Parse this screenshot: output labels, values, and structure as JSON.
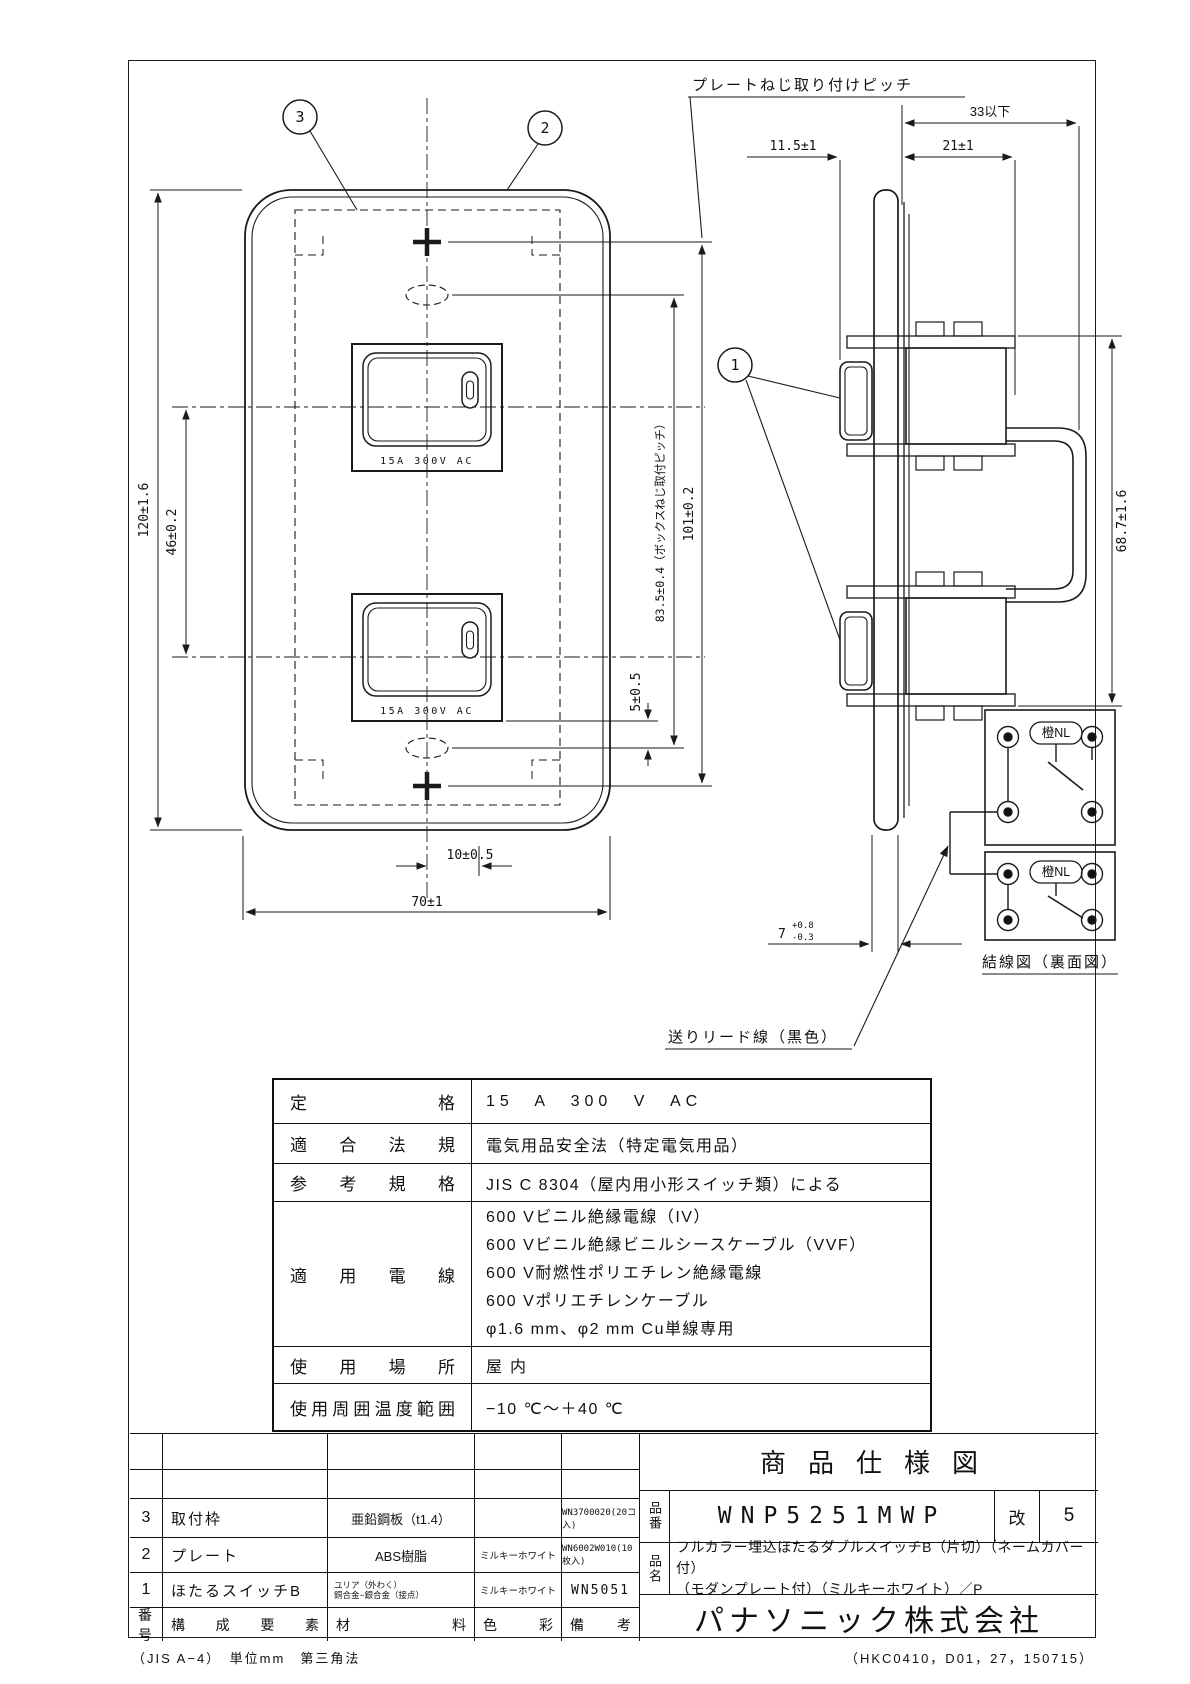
{
  "drawing": {
    "balloons": {
      "b1": "1",
      "b2": "2",
      "b3": "3"
    },
    "labels": {
      "plate_screw_pitch": "プレートねじ取り付けピッチ",
      "lead_wire": "送りリード線（黒色）",
      "wiring_title": "結線図（裏面図）",
      "lamp": "橙NL",
      "rating": "15A 300V AC"
    },
    "dims": {
      "d33": "33以下",
      "d11_5": "11.5±1",
      "d21": "21±1",
      "d120": "120±1.6",
      "d46": "46±0.2",
      "d101": "101±0.2",
      "d83_5": "83.5±0.4（ボックスねじ取付ピッチ）",
      "d5": "5±0.5",
      "d10": "10±0.5",
      "d70": "70±1",
      "d68_7": "68.7±1.6",
      "d7": "7",
      "d7p": "+0.8",
      "d7m": "-0.3"
    }
  },
  "spec_table": {
    "rows": [
      {
        "label": "定格",
        "value": "15 A 300 V AC"
      },
      {
        "label": "適合法規",
        "value": "電気用品安全法（特定電気用品）"
      },
      {
        "label": "参考規格",
        "value": "JIS C 8304（屋内用小形スイッチ類）による"
      },
      {
        "label": "適用電線",
        "lines": [
          "600 Vビニル絶縁電線（IV）",
          "600 Vビニル絶縁ビニルシースケーブル（VVF）",
          "600 V耐燃性ポリエチレン絶縁電線",
          "600 Vポリエチレンケーブル",
          "φ1.6 mm、φ2 mm Cu単線専用"
        ]
      },
      {
        "label": "使用場所",
        "value": "屋内"
      },
      {
        "label": "使用周囲温度範囲",
        "value": "−10 ℃～＋40 ℃"
      }
    ]
  },
  "parts_table": {
    "headers": [
      "番号",
      "構成要素",
      "材料",
      "色彩",
      "備考"
    ],
    "rows": [
      {
        "no": "3",
        "component": "取付枠",
        "material": "亜鉛鋼板（t1.4）",
        "material2": "",
        "color": "",
        "note": "WN3700020(20コ入)"
      },
      {
        "no": "2",
        "component": "プレート",
        "material": "ABS樹脂",
        "material2": "",
        "color": "ミルキーホワイト",
        "note": "WN6002W010(10枚入)"
      },
      {
        "no": "1",
        "component": "ほたるスイッチB",
        "material": "ユリア（外わく）",
        "material2": "銅合金−銀合金（接点）",
        "color": "ミルキーホワイト",
        "note": "WN5051"
      }
    ]
  },
  "title_block": {
    "title": "商品仕様図",
    "part_no_label": "品番",
    "part_no": "WNP5251MWP",
    "rev_label": "改",
    "rev": "5",
    "name_label": "品名",
    "name_line1": "フルカラー埋込ほたるダブルスイッチB（片切）（ネームカバー付）",
    "name_line2": "（モダンプレート付）（ミルキーホワイト）／P",
    "company": "パナソニック株式会社"
  },
  "footer": {
    "left": "（JIS A−4）　単位mm　第三角法",
    "right": "（HKC0410，D01，27，150715）"
  }
}
